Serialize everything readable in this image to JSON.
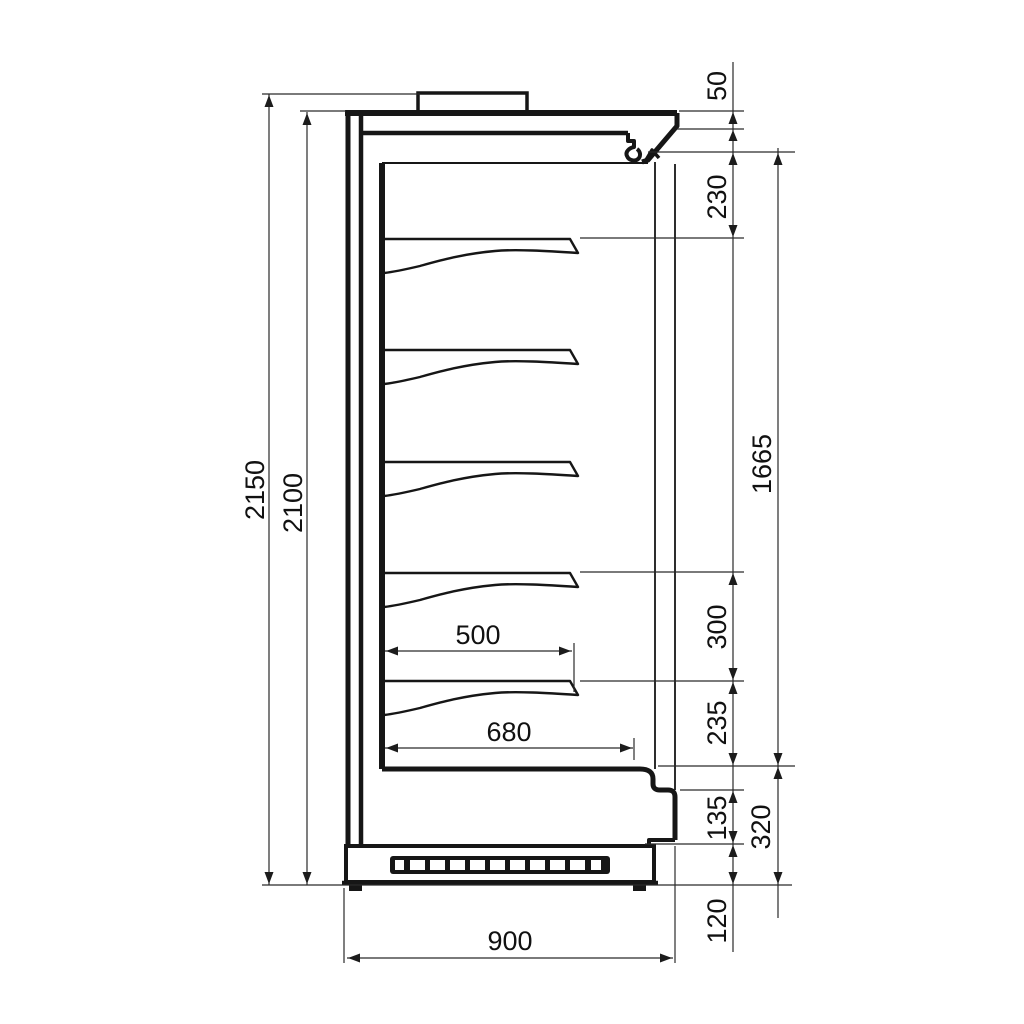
{
  "drawing": {
    "kind": "technical-dimension-drawing",
    "subject": "refrigerated multideck display cabinet - side section",
    "background_color": "#ffffff",
    "line_color": "#161616",
    "shelf_count": 5,
    "labels": {
      "overall_height": "2150",
      "body_height": "2100",
      "canopy_fascia": "50",
      "canopy_to_first_shelf": "230",
      "display_opening_height": "1665",
      "shelf_spacing": "300",
      "last_shelf_to_deck": "235",
      "lower_front_panel": "135",
      "deck_to_ground": "320",
      "plinth_height": "120",
      "overall_depth": "900",
      "shelf_depth": "500",
      "well_depth": "680"
    }
  }
}
